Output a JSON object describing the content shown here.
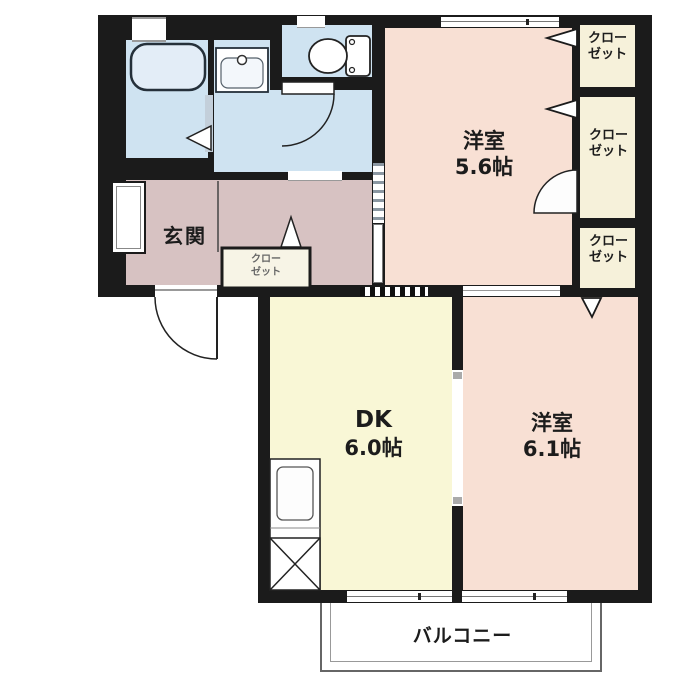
{
  "plan": {
    "entrance": {
      "label": "玄関"
    },
    "room_west_1": {
      "name": "洋室",
      "size": "5.6帖"
    },
    "room_west_2": {
      "name": "洋室",
      "size": "6.1帖"
    },
    "dk": {
      "name": "DK",
      "size": "6.0帖"
    },
    "balcony": {
      "label": "バルコニー"
    },
    "closet": {
      "line1": "クロー",
      "line2": "ゼット"
    },
    "hall_closet": {
      "line1": "クロー",
      "line2": "ゼット"
    },
    "colors": {
      "wall": "#1b1b1b",
      "room_pink": "#f8e0d4",
      "room_yellow": "#f9f7d6",
      "closet_cream": "#f6f1da",
      "hall_mauve": "#d7c2c2",
      "water_blue": "#cfe3f1",
      "background": "#ffffff"
    }
  }
}
